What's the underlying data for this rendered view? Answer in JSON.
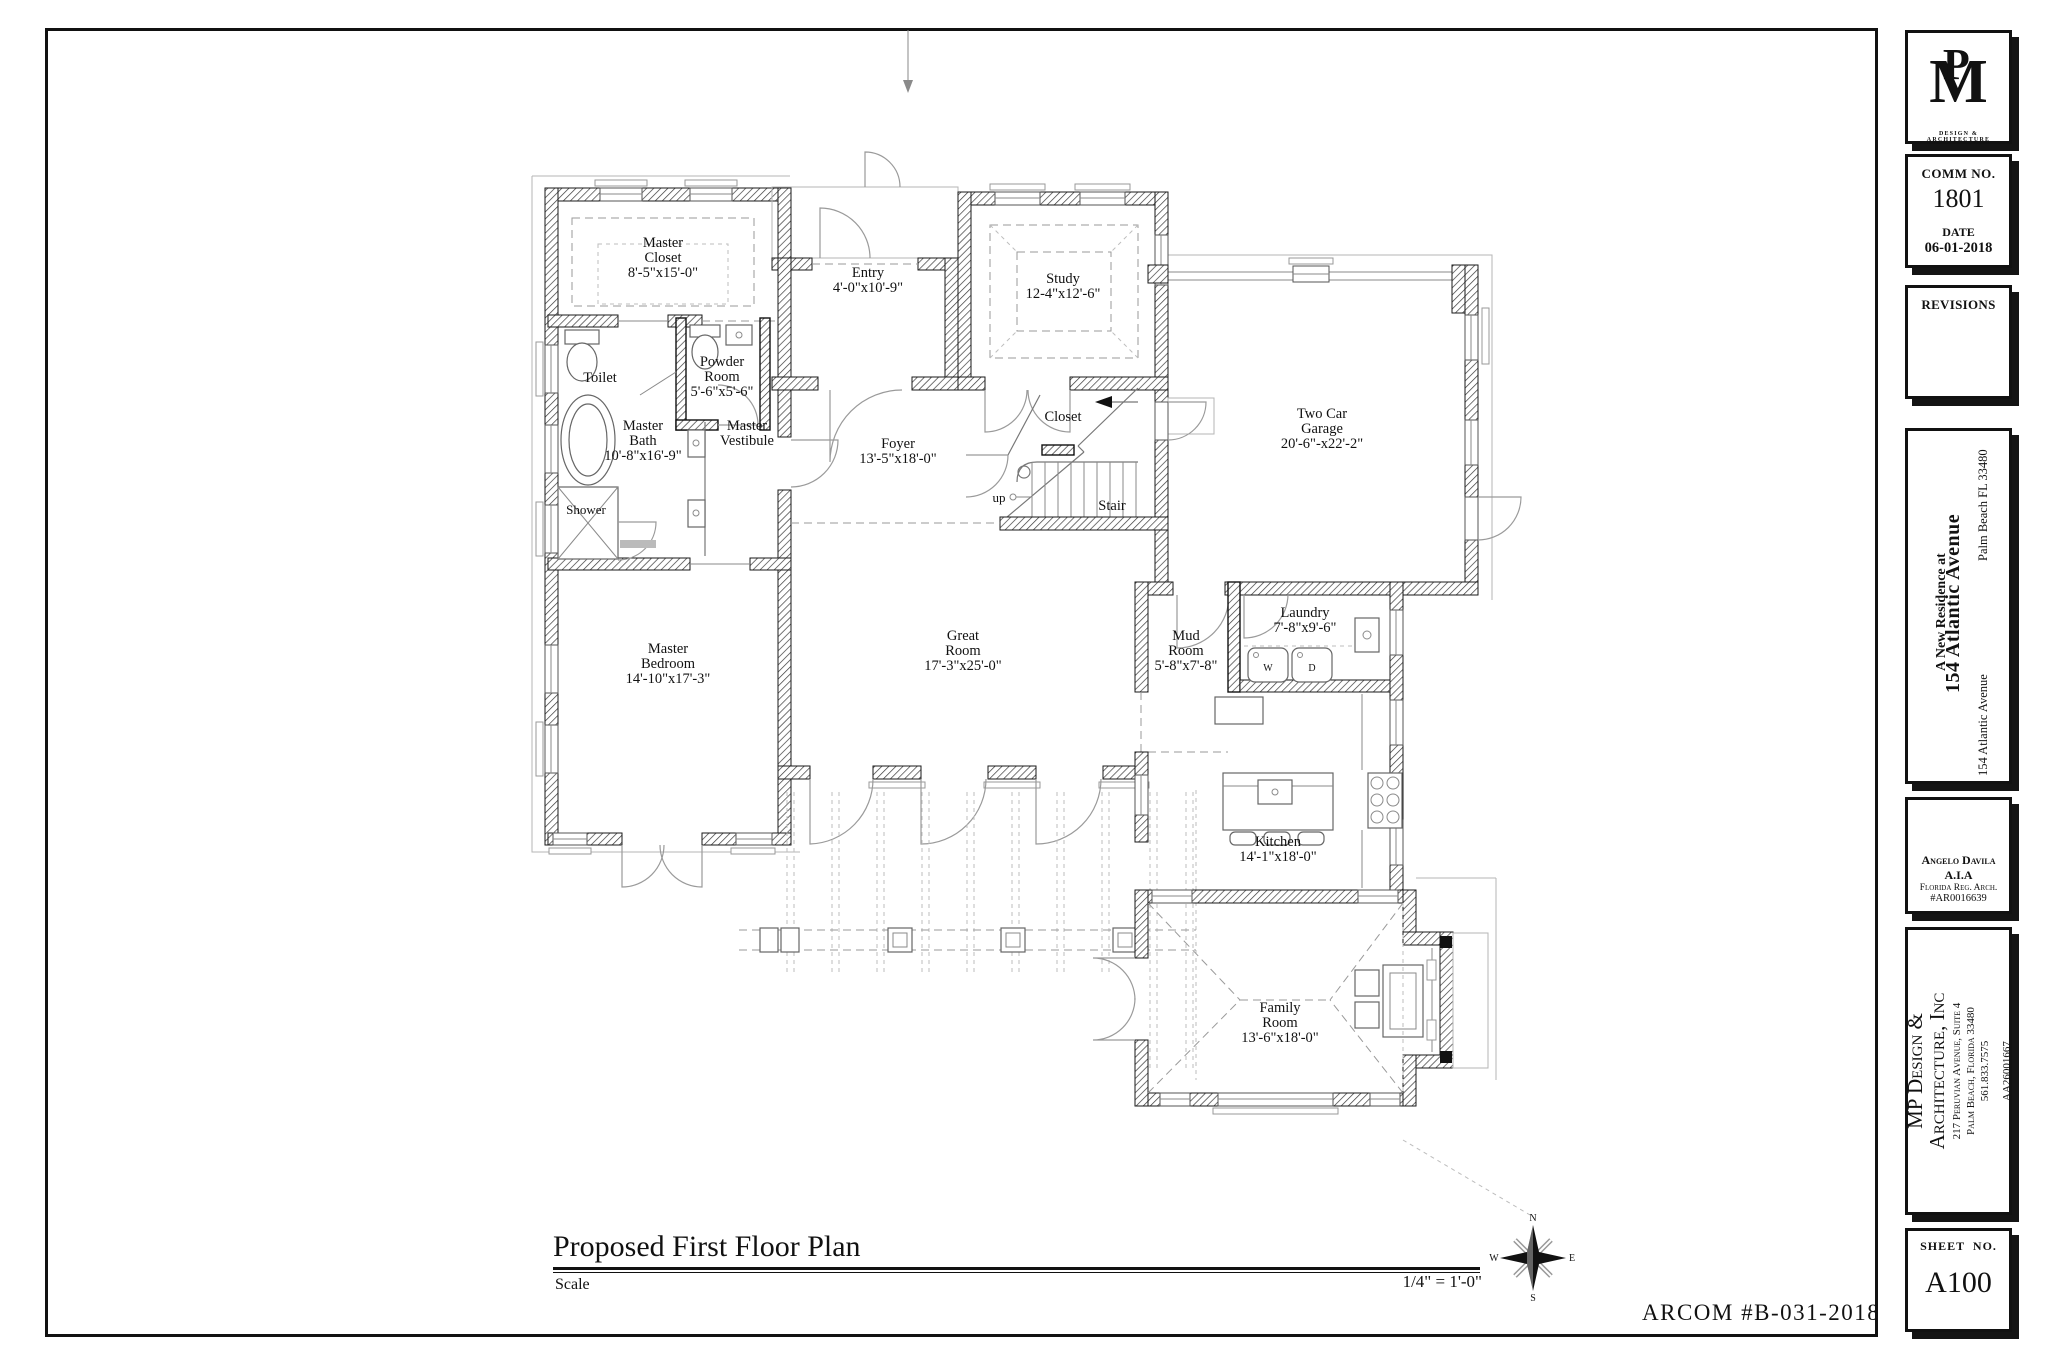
{
  "page": {
    "background": "#ffffff",
    "line_color": "#1a1a1a"
  },
  "title_block": {
    "logo": {
      "m": "M",
      "p": "P",
      "tagline": "DESIGN & ARCHITECTURE"
    },
    "comm": {
      "label": "COMM NO.",
      "value": "1801"
    },
    "date": {
      "label": "DATE",
      "value": "06-01-2018"
    },
    "revisions_label": "REVISIONS",
    "project": {
      "prefix": "A New Residence at",
      "name": "154 Atlantic Avenue",
      "city": "Palm Beach FL 33480",
      "street": "154 Atlantic Avenue"
    },
    "architect": {
      "name": "Angelo Davila A.I.A",
      "reg": "Florida Reg. Arch.",
      "number": "#AR0016639"
    },
    "firm": {
      "name1": "MP Design &",
      "name2": "Architecture, Inc",
      "address1": "217 Peruvian Avenue, Suite 4",
      "address2": "Palm Beach, Florida 33480",
      "phone": "561.833.7575",
      "license": "AA26001667"
    },
    "sheet": {
      "label": "SHEET  NO.",
      "value": "A100"
    }
  },
  "drawing": {
    "title": "Proposed First Floor Plan",
    "scale_label": "Scale",
    "scale_value": "1/4\" = 1'-0\"",
    "stamp": "ARCOM #B-031-2018",
    "compass": {
      "n": "N",
      "e": "E",
      "s": "S",
      "w": "W"
    }
  },
  "rooms": {
    "master_closet": {
      "lines": [
        "Master",
        "Closet",
        "8'-5\"x15'-0\""
      ]
    },
    "entry": {
      "lines": [
        "Entry",
        "4'-0\"x10'-9\""
      ]
    },
    "study": {
      "lines": [
        "Study",
        "12-4\"x12'-6\""
      ]
    },
    "garage": {
      "lines": [
        "Two Car",
        "Garage",
        "20'-6\"-x22'-2\""
      ]
    },
    "toilet": {
      "lines": [
        "Toilet"
      ]
    },
    "powder": {
      "lines": [
        "Powder",
        "Room",
        "5'-6\"x5'-6\""
      ]
    },
    "master_bath": {
      "lines": [
        "Master",
        "Bath",
        "10'-8\"x16'-9\""
      ]
    },
    "master_vestibule": {
      "lines": [
        "Master",
        "Vestibule"
      ]
    },
    "shower": {
      "lines": [
        "Shower"
      ]
    },
    "foyer": {
      "lines": [
        "Foyer",
        "13'-5\"x18'-0\""
      ]
    },
    "closet": {
      "lines": [
        "Closet"
      ]
    },
    "stair": {
      "lines": [
        "Stair"
      ]
    },
    "up": {
      "lines": [
        "up"
      ]
    },
    "great_room": {
      "lines": [
        "Great",
        "Room",
        "17'-3\"x25'-0\""
      ]
    },
    "master_bedroom": {
      "lines": [
        "Master",
        "Bedroom",
        "14'-10\"x17'-3\""
      ]
    },
    "mud_room": {
      "lines": [
        "Mud",
        "Room",
        "5'-8\"x7'-8\""
      ]
    },
    "laundry": {
      "lines": [
        "Laundry",
        "7'-8\"x9'-6\""
      ]
    },
    "kitchen": {
      "lines": [
        "Kitchen",
        "14'-1\"x18'-0\""
      ]
    },
    "family_room": {
      "lines": [
        "Family",
        "Room",
        "13'-6\"x18'-0\""
      ]
    }
  },
  "fixtures": {
    "washer": "W",
    "dryer": "D"
  }
}
